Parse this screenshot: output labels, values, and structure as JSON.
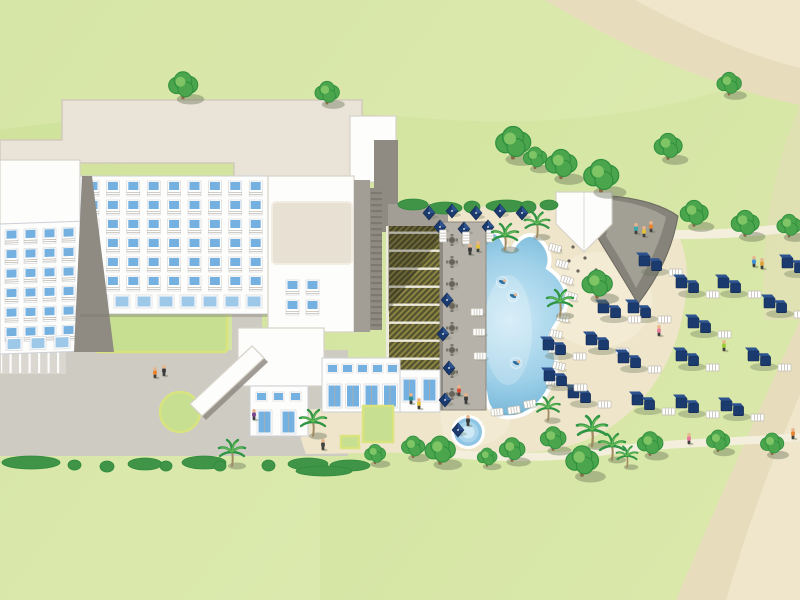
{
  "meta": {
    "title": "Resort site map illustration",
    "alt": "Aerial illustrated map of a beach resort: large white hotel with blue balcony windows, plaza with roundabout and covered walkway, lattice pergola, pool deck with tables, free-form swimming pool with swimmers, round kids pool, pool bar with gray sail canopy, navy cabana loungers scattered on the lawn, palm trees, hedges and sandy beach paths"
  },
  "colors": {
    "grass1": "#cfe29a",
    "grass2": "#dbe9ac",
    "waveLight": "#e8f1c4",
    "sandCorner": "#e7dcbb",
    "sandCorner2": "#efe6cb",
    "sandTerrace": "#efe5cb",
    "sandLight": "#f6efdc",
    "pathway": "#f4efdd",
    "plaza": "#cecbc3",
    "parking": "#dad7d0",
    "courtyard": "#c6df90",
    "curb": "#d9e47f",
    "roofPlate": "#eae4d8",
    "roofBorder": "#d2cabb",
    "white": "#fdfdfb",
    "borderLight": "#d6d2c8",
    "facadeBorder": "#ccd0d6",
    "wallGray": "#8f8b83",
    "wallMid": "#a29e96",
    "wallDark": "#6e6a62",
    "window": "#74b0e0",
    "windowLight": "#9ec8e8",
    "railGray": "#b4afa5",
    "pergolaDark": "#565530",
    "pergolaTex": "#9f9349",
    "beam": "#ece9dd",
    "deck": "#b6b2a9",
    "deckEdge": "#8f8b82",
    "poolEdge": "#63aacf",
    "poolMid": "#9ccfe8",
    "poolLight": "#cfeaf6",
    "poolRim": "#ffffff",
    "hedge": "#3f9447",
    "hedgeDark": "#2f8a3c",
    "treeGreen": "#4aa54c",
    "treeDark": "#2e8f3e",
    "treeLight": "#85c968",
    "trunk": "#8a6a44",
    "palmGreen": "#2f9444",
    "palmLight": "#63bb55",
    "palmTrunk": "#a08a62",
    "shadow": "rgba(105,115,88,0.42)",
    "navy": "#1b3a6e",
    "navyLight": "#2d538f",
    "bedWhite": "#ffffff",
    "bedLine": "#c2beb2",
    "canopyDark": "#85837a",
    "canopyLight": "#a7a49a",
    "canopyEdge": "#6b695f",
    "skylight": "#e7e0d3",
    "skin": "#e9b58c",
    "legs": "#3f3f3f",
    "tableGray": "#67635b"
  },
  "scene": {
    "trees": [
      [
        183,
        88,
        1.25
      ],
      [
        327,
        95,
        1.05
      ],
      [
        513,
        146,
        1.5
      ],
      [
        535,
        160,
        1.0
      ],
      [
        561,
        167,
        1.35
      ],
      [
        601,
        179,
        1.5
      ],
      [
        668,
        149,
        1.2
      ],
      [
        729,
        86,
        1.05
      ],
      [
        694,
        216,
        1.2
      ],
      [
        745,
        226,
        1.2
      ],
      [
        789,
        228,
        1.05
      ],
      [
        597,
        287,
        1.3
      ],
      [
        375,
        456,
        0.9
      ],
      [
        413,
        449,
        1.0
      ],
      [
        440,
        453,
        1.3
      ],
      [
        487,
        459,
        0.85
      ],
      [
        512,
        452,
        1.1
      ],
      [
        553,
        441,
        1.1
      ],
      [
        582,
        464,
        1.4
      ],
      [
        650,
        446,
        1.1
      ],
      [
        718,
        443,
        1.0
      ],
      [
        772,
        446,
        1.0
      ]
    ],
    "palms": [
      [
        505,
        236,
        1.0
      ],
      [
        537,
        224,
        0.95
      ],
      [
        560,
        302,
        1.0
      ],
      [
        548,
        408,
        0.9
      ],
      [
        592,
        430,
        1.15
      ],
      [
        612,
        446,
        1.0
      ],
      [
        627,
        456,
        0.8
      ],
      [
        232,
        452,
        1.0
      ],
      [
        313,
        422,
        1.0
      ]
    ],
    "bushes": [
      [
        2,
        456,
        58,
        13
      ],
      [
        68,
        460,
        13,
        10
      ],
      [
        100,
        461,
        14,
        11
      ],
      [
        128,
        458,
        34,
        12
      ],
      [
        160,
        461,
        12,
        10
      ],
      [
        182,
        456,
        44,
        13
      ],
      [
        214,
        461,
        12,
        10
      ],
      [
        262,
        460,
        13,
        11
      ],
      [
        288,
        458,
        40,
        12
      ],
      [
        330,
        460,
        40,
        11
      ],
      [
        296,
        466,
        56,
        10
      ],
      [
        398,
        199,
        30,
        11
      ],
      [
        428,
        202,
        34,
        12
      ],
      [
        464,
        201,
        16,
        12
      ],
      [
        486,
        200,
        40,
        12
      ],
      [
        520,
        201,
        16,
        12
      ],
      [
        540,
        200,
        18,
        10
      ]
    ],
    "cabanas": [
      [
        645,
        262
      ],
      [
        788,
        264
      ],
      [
        682,
        284
      ],
      [
        724,
        284
      ],
      [
        770,
        304
      ],
      [
        634,
        309
      ],
      [
        604,
        309
      ],
      [
        694,
        324
      ],
      [
        592,
        341
      ],
      [
        754,
        357
      ],
      [
        624,
        359
      ],
      [
        682,
        357
      ],
      [
        574,
        394
      ],
      [
        638,
        401
      ],
      [
        682,
        404
      ],
      [
        727,
        407
      ],
      [
        549,
        346
      ],
      [
        550,
        377
      ]
    ],
    "umbrellas": [
      [
        429,
        213
      ],
      [
        452,
        211
      ],
      [
        476,
        213
      ],
      [
        500,
        211
      ],
      [
        522,
        213
      ],
      [
        440,
        227
      ],
      [
        464,
        229
      ],
      [
        488,
        227
      ],
      [
        447,
        300
      ],
      [
        443,
        334
      ],
      [
        449,
        368
      ],
      [
        445,
        400
      ],
      [
        458,
        430
      ]
    ],
    "sunbeds": [
      [
        555,
        248,
        15
      ],
      [
        562,
        264,
        15
      ],
      [
        567,
        280,
        18
      ],
      [
        571,
        296,
        20
      ],
      [
        563,
        318,
        12
      ],
      [
        556,
        334,
        10
      ],
      [
        555,
        350,
        8
      ],
      [
        559,
        366,
        12
      ],
      [
        552,
        382,
        8
      ],
      [
        497,
        412,
        -5
      ],
      [
        514,
        410,
        -8
      ],
      [
        530,
        404,
        -10
      ],
      [
        477,
        312,
        0
      ],
      [
        479,
        332,
        0
      ],
      [
        480,
        356,
        0
      ],
      [
        443,
        236,
        90
      ],
      [
        466,
        238,
        90
      ],
      [
        490,
        236,
        90
      ]
    ],
    "tables": [
      [
        452,
        240
      ],
      [
        452,
        262
      ],
      [
        452,
        284
      ],
      [
        452,
        306
      ],
      [
        452,
        328
      ],
      [
        452,
        350
      ],
      [
        452,
        372
      ],
      [
        452,
        394
      ]
    ],
    "bar_furniture": [
      [
        573,
        247
      ],
      [
        585,
        258
      ],
      [
        596,
        270
      ],
      [
        578,
        271
      ],
      [
        590,
        282
      ],
      [
        603,
        288
      ],
      [
        569,
        261
      ],
      [
        560,
        250
      ]
    ],
    "people": [
      [
        155,
        373,
        "#e8832f"
      ],
      [
        164,
        371,
        "#3b3b3b"
      ],
      [
        470,
        250,
        "#3b3b3b"
      ],
      [
        478,
        247,
        "#e4c23a"
      ],
      [
        459,
        391,
        "#d84a35"
      ],
      [
        466,
        399,
        "#3b3b3b"
      ],
      [
        411,
        399,
        "#2f8d8d"
      ],
      [
        419,
        404,
        "#e4c23a"
      ],
      [
        254,
        415,
        "#7a4390"
      ],
      [
        323,
        445,
        "#444444"
      ],
      [
        636,
        229,
        "#35aab2"
      ],
      [
        644,
        232,
        "#e4c23a"
      ],
      [
        651,
        227,
        "#e8832f"
      ],
      [
        659,
        331,
        "#e87a9a"
      ],
      [
        724,
        346,
        "#9ccf35"
      ],
      [
        754,
        262,
        "#3a90d8"
      ],
      [
        762,
        264,
        "#e0a33a"
      ],
      [
        689,
        439,
        "#e87a9a"
      ],
      [
        793,
        434,
        "#e8832f"
      ],
      [
        468,
        421,
        "#3b3b3b"
      ]
    ],
    "swimmers": [
      [
        502,
        282
      ],
      [
        513,
        296
      ],
      [
        516,
        363
      ]
    ],
    "windows": {
      "main": {
        "def": "window",
        "x": 86,
        "y": 181,
        "cols": 9,
        "rows": 6,
        "dx": 20.4,
        "dy": 19,
        "layer": "win-main"
      },
      "mainGround": {
        "def": "gwindow",
        "x": 92,
        "y": 295,
        "cols": 8,
        "rows": 1,
        "dx": 22,
        "dy": 0,
        "layer": "win-mainGround"
      },
      "left": {
        "def": "window",
        "x": 5,
        "y": 6,
        "cols": 4,
        "rows": 6,
        "dx": 19,
        "dy": 19.5,
        "layer": "win-left"
      },
      "leftGround": {
        "def": "gwindow",
        "x": 6,
        "y": 114,
        "cols": 3,
        "rows": 1,
        "dx": 24,
        "dy": 0,
        "layer": "win-leftGround"
      },
      "center": {
        "def": "window",
        "x": 286,
        "y": 280,
        "cols": 2,
        "rows": 2,
        "dx": 20,
        "dy": 20,
        "layer": "win-center"
      },
      "lobbyTop": {
        "def": "swindow",
        "x": 327,
        "y": 364,
        "cols": 5,
        "rows": 1,
        "dx": 15,
        "dy": 0,
        "layer": "win-lobbyTop"
      },
      "lobbyDoors": {
        "def": "door",
        "x": 327,
        "y": 384,
        "cols": 4,
        "rows": 1,
        "dx": 18.5,
        "dy": 0,
        "layer": "win-lobbyDoors"
      },
      "restWin": {
        "def": "swindow",
        "x": 256,
        "y": 392,
        "cols": 3,
        "rows": 1,
        "dx": 17,
        "dy": 0,
        "layer": "win-restWin"
      },
      "restDoors": {
        "def": "door",
        "x": 257,
        "y": 410,
        "cols": 2,
        "rows": 1,
        "dx": 24,
        "dy": 0,
        "layer": "win-restDoors"
      },
      "annexDoors": {
        "def": "door",
        "x": 402,
        "y": 378,
        "cols": 2,
        "rows": 1,
        "dx": 20,
        "dy": 0,
        "layer": "win-annexDoors"
      }
    }
  }
}
